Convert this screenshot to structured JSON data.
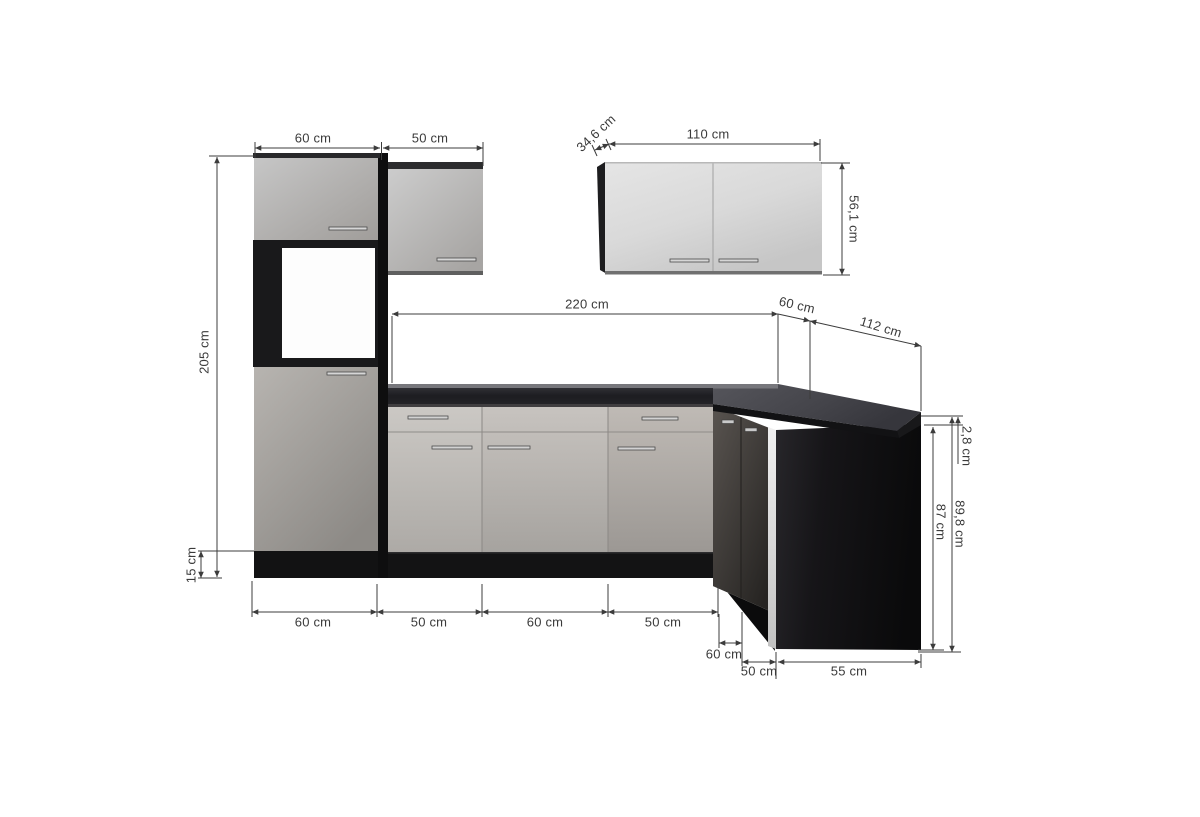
{
  "figure": {
    "type": "kitchen-corner-unit-dimension-diagram",
    "unit": "cm"
  },
  "labels": {
    "tall_cab_width": "60 cm",
    "wall_cab_50_width": "50 cm",
    "wall_cab_110_depth": "34,6 cm",
    "wall_cab_110_width": "110 cm",
    "wall_cab_110_height": "56,1 cm",
    "tall_cab_height": "205 cm",
    "plinth_height": "15 cm",
    "run_length": "220 cm",
    "corner_depth": "60 cm",
    "right_run_length": "112 cm",
    "worktop_thickness": "2,8 cm",
    "base_cab_height": "87 cm",
    "total_base_height": "89,8 cm",
    "base_seg_1": "60 cm",
    "base_seg_2": "50 cm",
    "base_seg_3": "60 cm",
    "base_seg_4": "50 cm",
    "corner_bottom_depth": "60 cm",
    "corner_bottom_width": "50 cm",
    "side_panel_depth": "55 cm"
  },
  "colors": {
    "background": "#ffffff",
    "door_light_grey": "#c6c3bf",
    "carcass_dark": "#141415",
    "worktop_dark": "#3f3f44",
    "corner_door_brown": "#4e4843",
    "dimension_line": "#3c3c3c"
  }
}
